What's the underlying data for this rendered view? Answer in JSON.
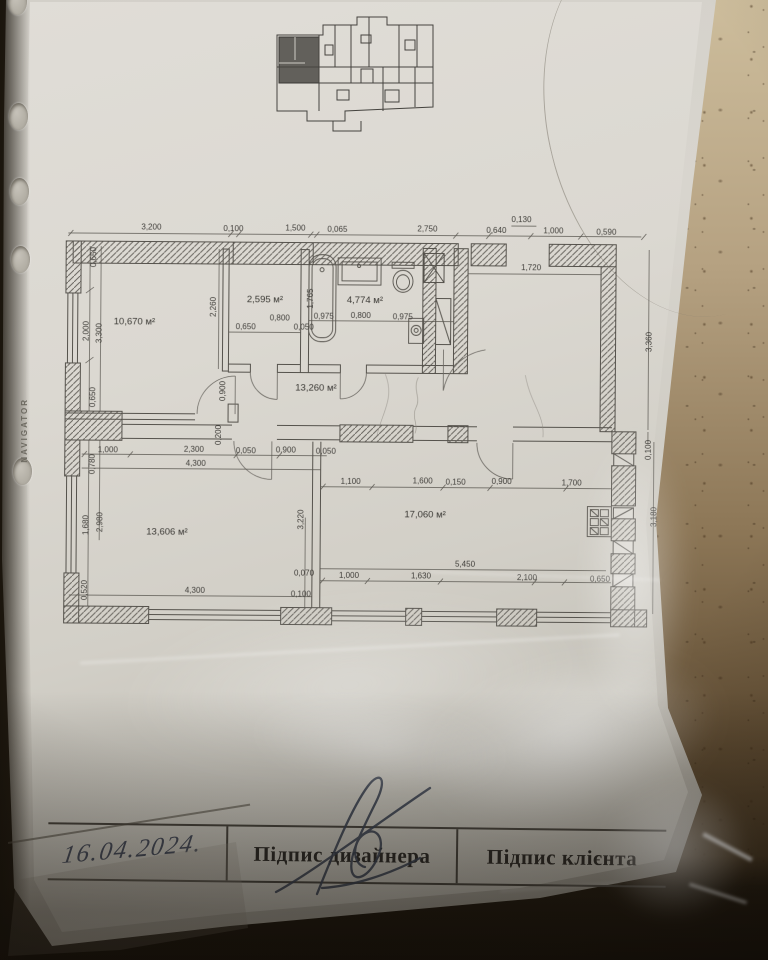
{
  "photo": {
    "sleeve_brand": "NAVIGATOR",
    "palette": {
      "paper": "#d8d5ce",
      "floor_tile": "#a08a68",
      "ink": "#39404f",
      "plan_lines": "#55524c"
    }
  },
  "floor_plan": {
    "room_areas": {
      "bedroom1": "10,670 м²",
      "wardrobe": "2,595 м²",
      "bathroom": "4,774 м²",
      "hall": "13,260 м²",
      "bedroom2": "13,606 м²",
      "living": "17,060 м²"
    },
    "dims_top": [
      "3,200",
      "0,100",
      "1,500",
      "0,065",
      "2,750",
      "0,640",
      "0,130",
      "1,000",
      "0,590"
    ],
    "dims_left_upper": [
      "0,650",
      "2,000",
      "3,300",
      "0,650"
    ],
    "dims_left_lower": [
      "0,780",
      "1,680",
      "2,980",
      "0,520"
    ],
    "dims_right": [
      "1,720",
      "3,360",
      "0,100",
      "3,180"
    ],
    "dim_room2_depth": "2,260",
    "dims_room2_bottom": [
      "0,650",
      "0,800",
      "0,050"
    ],
    "dim_bathtub": "1,765",
    "dims_bath_bottom": [
      "0,975",
      "0,800",
      "0,975"
    ],
    "dims_hall_door": [
      "0,900",
      "0,200"
    ],
    "dims_mid_row": [
      "1,000",
      "2,300",
      "0,050",
      "0,900",
      "0,050"
    ],
    "dim_mid_total": "4,300",
    "dim_room3_bottom": "4,300",
    "dim_partition": "3,220",
    "dims_living_top": [
      "1,100",
      "1,600",
      "0,150",
      "0,900",
      "1,700"
    ],
    "dim_living_width": "5,450",
    "dims_living_bottom": [
      "1,000",
      "1,630",
      "2,100",
      "0,650"
    ],
    "dims_living_left": [
      "0,070",
      "0,100"
    ]
  },
  "title_block": {
    "date": "16.04.2024.",
    "designer_label": "Підпис дизайнера",
    "client_label": "Підпис клієнта"
  }
}
